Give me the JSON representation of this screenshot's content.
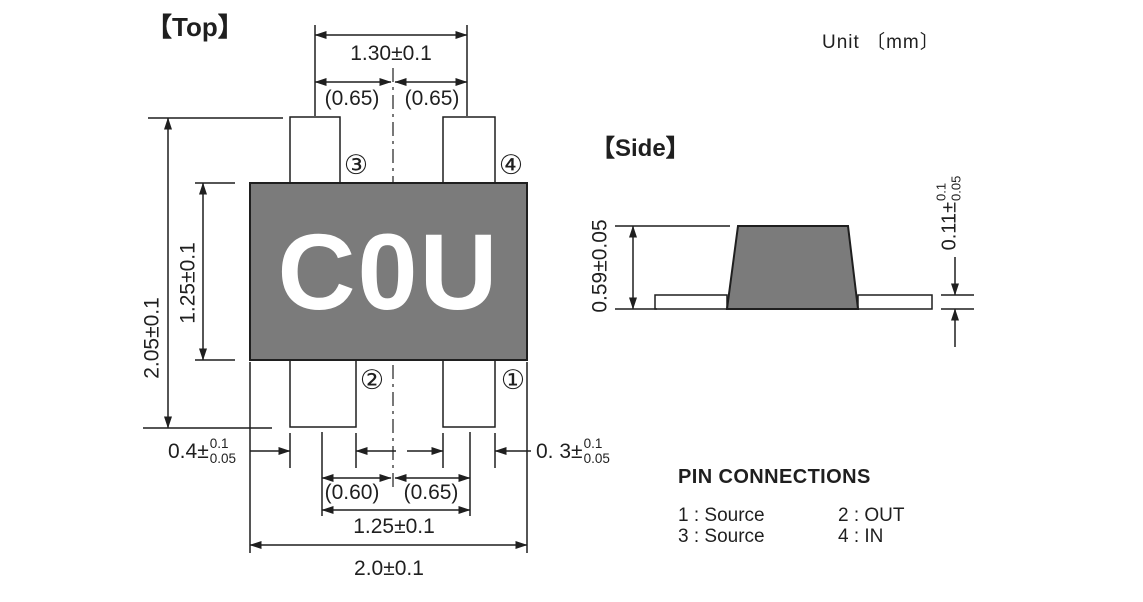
{
  "unit_label": "Unit 〔mm〕",
  "top_view": {
    "label": "【Top】",
    "marking": "C0U",
    "pins": {
      "p1": "①",
      "p2": "②",
      "p3": "③",
      "p4": "④"
    },
    "dims": {
      "lead_span_top": "1.30±0.1",
      "pitch_top_left": "(0.65)",
      "pitch_top_right": "(0.65)",
      "overall_height": "2.05±0.1",
      "body_height": "1.25±0.1",
      "lead_width_left": {
        "value": "0.4±",
        "tol_upper": "0.1",
        "tol_lower": "0.05"
      },
      "lead_width_right": {
        "value": "0. 3±",
        "tol_upper": "0.1",
        "tol_lower": "0.05"
      },
      "pitch_bottom_left": "(0.60)",
      "pitch_bottom_right": "(0.65)",
      "lead_span_bottom": "1.25±0.1",
      "overall_width": "2.0±0.1"
    }
  },
  "side_view": {
    "label": "【Side】",
    "dims": {
      "body_height": "0.59±0.05",
      "lead_thickness": {
        "value": "0.11±",
        "tol_upper": "0.1",
        "tol_lower": "0.05"
      }
    }
  },
  "pin_connections": {
    "title": "PIN CONNECTIONS",
    "entries": [
      "1 : Source",
      "2 : OUT",
      "3 : Source",
      "4 : IN"
    ]
  },
  "colors": {
    "body_fill": "#7b7b7b",
    "line": "#1f1f1f",
    "marking_text": "#ffffff"
  }
}
